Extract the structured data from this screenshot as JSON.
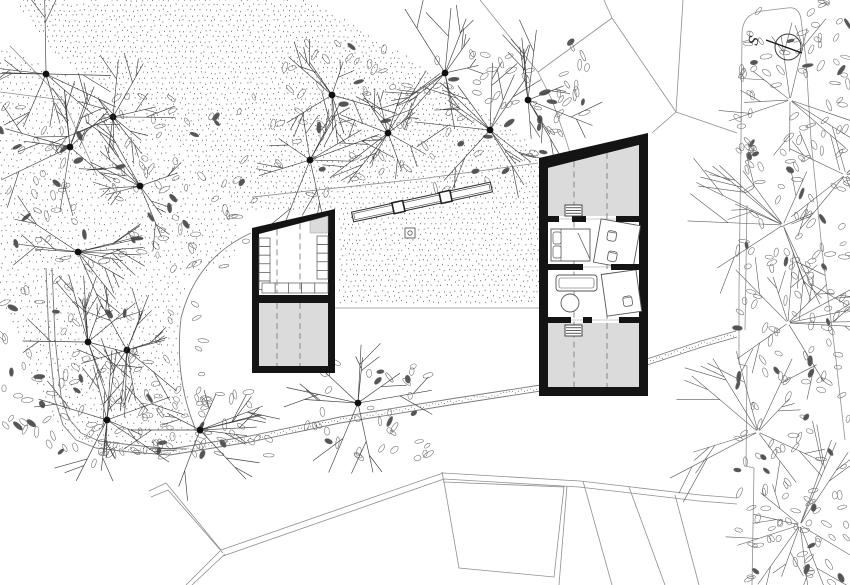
{
  "canvas": {
    "width": 850,
    "height": 585,
    "bg": "#ffffff"
  },
  "colors": {
    "wall": "#141414",
    "room_gray": "#dbdbdb",
    "thin_line": "#8f8f8f",
    "path_line": "#7a7a7a",
    "dot": "#4d4d4d",
    "leaf": "#6a6a6a",
    "leaf_fill": "#555555",
    "branch": "#3f3f3f",
    "hedge_branch": "#5a5a5a",
    "furniture": "#555555",
    "dash": "#808080",
    "trunk": "#111111"
  },
  "compass": {
    "label": "S",
    "cx": 788,
    "cy": 47,
    "r": 13,
    "needle": [
      766,
      40,
      802,
      53
    ],
    "label_pos": [
      758,
      42
    ],
    "label_rotate": -72
  },
  "stipple_regions": [
    {
      "polygon": [
        [
          15,
          0
        ],
        [
          310,
          0
        ],
        [
          420,
          65
        ],
        [
          538,
          150
        ],
        [
          538,
          306
        ],
        [
          338,
          306
        ],
        [
          338,
          212
        ],
        [
          240,
          212
        ],
        [
          150,
          118
        ],
        [
          55,
          55
        ]
      ],
      "spacing": 5.2,
      "jitter": 1.3
    },
    {
      "polygon": [
        [
          0,
          45
        ],
        [
          140,
          115
        ],
        [
          232,
          205
        ],
        [
          237,
          255
        ],
        [
          186,
          278
        ],
        [
          176,
          330
        ],
        [
          188,
          405
        ],
        [
          205,
          443
        ],
        [
          120,
          448
        ],
        [
          60,
          430
        ],
        [
          0,
          305
        ]
      ],
      "spacing": 6.4,
      "jitter": 1.6
    }
  ],
  "leaf_regions": [
    {
      "x": 0,
      "y": 90,
      "w": 70,
      "h": 380,
      "count": 60
    },
    {
      "x": 55,
      "y": 95,
      "w": 200,
      "h": 175,
      "count": 85
    },
    {
      "x": 55,
      "y": 300,
      "w": 150,
      "h": 165,
      "count": 65
    },
    {
      "x": 270,
      "y": 40,
      "w": 290,
      "h": 155,
      "count": 100
    },
    {
      "x": 538,
      "y": 42,
      "w": 52,
      "h": 100,
      "count": 22
    },
    {
      "x": 95,
      "y": 390,
      "w": 175,
      "h": 70,
      "count": 45
    },
    {
      "x": 305,
      "y": 355,
      "w": 125,
      "h": 105,
      "count": 40
    },
    {
      "x": 737,
      "y": 0,
      "w": 113,
      "h": 585,
      "count": 250
    }
  ],
  "trees": {
    "dotted": [
      [
        46,
        74
      ],
      [
        113,
        117
      ],
      [
        70,
        147
      ],
      [
        140,
        186
      ],
      [
        78,
        252
      ],
      [
        310,
        160
      ],
      [
        332,
        95
      ],
      [
        388,
        133
      ],
      [
        445,
        73
      ],
      [
        490,
        130
      ],
      [
        528,
        100
      ],
      [
        88,
        342
      ],
      [
        127,
        350
      ],
      [
        107,
        420
      ],
      [
        200,
        430
      ],
      [
        358,
        403
      ]
    ],
    "plain": [
      [
        790,
        100
      ],
      [
        783,
        225
      ],
      [
        788,
        323
      ],
      [
        758,
        432
      ],
      [
        800,
        525
      ],
      [
        845,
        175
      ]
    ]
  },
  "lines": {
    "thin_polylines": [
      [
        [
          480,
          0
        ],
        [
          538,
          72
        ],
        [
          552,
          100
        ],
        [
          566,
          140
        ],
        [
          574,
          166
        ]
      ],
      [
        [
          538,
          72
        ],
        [
          612,
          18
        ],
        [
          604,
          0
        ]
      ],
      [
        [
          612,
          18
        ],
        [
          676,
          112
        ],
        [
          737,
          133
        ]
      ],
      [
        [
          683,
          0
        ],
        [
          676,
          112
        ]
      ],
      [
        [
          652,
          133
        ],
        [
          676,
          112
        ]
      ],
      [
        [
          252,
          197
        ],
        [
          420,
          179
        ],
        [
          538,
          163
        ]
      ],
      [
        [
          10,
          46
        ],
        [
          63,
          100
        ],
        [
          97,
          176
        ]
      ],
      [
        [
          0,
          92
        ],
        [
          63,
          100
        ]
      ],
      [
        [
          335,
          308
        ],
        [
          539,
          308
        ]
      ],
      [
        [
          567,
          486
        ],
        [
          559,
          585
        ]
      ],
      [
        [
          583,
          481
        ],
        [
          612,
          585
        ]
      ],
      [
        [
          629,
          487
        ],
        [
          665,
          585
        ]
      ],
      [
        [
          675,
          495
        ],
        [
          699,
          585
        ]
      ],
      [
        [
          442,
          472
        ],
        [
          444,
          483
        ]
      ],
      [
        [
          742,
          34
        ],
        [
          741,
          140
        ],
        [
          739,
          290
        ],
        [
          739,
          364
        ],
        [
          747,
          366
        ],
        [
          746,
          466
        ],
        [
          754,
          468
        ],
        [
          752,
          585
        ]
      ],
      [
        [
          747,
          205
        ],
        [
          745,
          330
        ]
      ],
      [
        [
          742,
          42
        ],
        [
          749,
          40
        ],
        [
          750,
          31
        ]
      ],
      [
        [
          149,
          491
        ],
        [
          166,
          483
        ],
        [
          221,
          550
        ]
      ],
      [
        [
          151,
          497
        ],
        [
          168,
          490
        ],
        [
          223,
          553
        ]
      ],
      [
        [
          220,
          551
        ],
        [
          186,
          585
        ]
      ],
      [
        [
          225,
          554
        ],
        [
          192,
          585
        ]
      ],
      [
        [
          221,
          550
        ],
        [
          443,
          473
        ],
        [
          580,
          481
        ],
        [
          700,
          495
        ],
        [
          737,
          498
        ]
      ],
      [
        [
          223,
          556
        ],
        [
          444,
          479
        ],
        [
          579,
          487
        ],
        [
          699,
          501
        ],
        [
          737,
          504
        ]
      ]
    ],
    "pentagon": [
      [
        444,
        482
      ],
      [
        564,
        487
      ],
      [
        554,
        577
      ],
      [
        459,
        568
      ]
    ],
    "arc_path": "M 251 233 Q 196 258 181 318 Q 175 372 191 417 L 196 431",
    "hedge_cap_path": "M 742 34 Q 742 14 762 11 L 787 8 Q 799 6 801 19 L 806 60 L 811 140 L 822 250 L 836 360 L 845 440"
  },
  "gravel_path": {
    "outer": [
      [
        46,
        268
      ],
      [
        49,
        340
      ],
      [
        55,
        400
      ],
      [
        63,
        425
      ],
      [
        76,
        440
      ],
      [
        96,
        448
      ],
      [
        130,
        452
      ],
      [
        170,
        455
      ],
      [
        250,
        442
      ],
      [
        340,
        423
      ],
      [
        450,
        405
      ],
      [
        560,
        388
      ],
      [
        650,
        364
      ],
      [
        702,
        347
      ],
      [
        737,
        337
      ]
    ],
    "inner": [
      [
        52,
        268
      ],
      [
        55,
        338
      ],
      [
        61,
        396
      ],
      [
        69,
        419
      ],
      [
        81,
        433
      ],
      [
        99,
        441
      ],
      [
        132,
        445
      ],
      [
        170,
        449
      ],
      [
        250,
        436
      ],
      [
        340,
        417
      ],
      [
        450,
        399
      ],
      [
        560,
        382
      ],
      [
        650,
        358
      ],
      [
        701,
        341
      ],
      [
        736,
        331
      ]
    ],
    "center": [
      [
        49,
        268
      ],
      [
        52,
        339
      ],
      [
        58,
        398
      ],
      [
        66,
        422
      ],
      [
        79,
        437
      ],
      [
        98,
        445
      ],
      [
        131,
        449
      ],
      [
        170,
        452
      ],
      [
        250,
        439
      ],
      [
        340,
        420
      ],
      [
        450,
        402
      ],
      [
        560,
        385
      ],
      [
        650,
        361
      ],
      [
        701,
        344
      ],
      [
        736,
        334
      ]
    ],
    "dots_from_index": 4
  },
  "bench": {
    "cx": 422,
    "cy": 202,
    "len": 142,
    "wid": 10,
    "rot": -12.2,
    "squares": [
      0.33,
      0.67
    ],
    "sq": 11
  },
  "marker": {
    "rect": [
      405,
      228,
      10,
      10
    ],
    "r": 2.2
  },
  "left_cabin": {
    "outer": [
      [
        252,
        228
      ],
      [
        335,
        209
      ],
      [
        335,
        373
      ],
      [
        252,
        373
      ]
    ],
    "inner": [
      [
        259,
        234
      ],
      [
        328,
        216
      ],
      [
        328,
        366
      ],
      [
        259,
        366
      ]
    ],
    "divider": [
      252,
      295,
      335,
      303
    ],
    "bottom_room": [
      [
        259,
        303
      ],
      [
        328,
        303
      ],
      [
        328,
        366
      ],
      [
        259,
        366
      ]
    ],
    "gray_quad": [
      [
        310,
        221
      ],
      [
        328,
        216
      ],
      [
        328,
        233
      ],
      [
        310,
        233
      ]
    ],
    "shelves": {
      "left": {
        "x": 259,
        "w": 11,
        "y0": 238,
        "rows": 6,
        "rh": 8.6
      },
      "right": {
        "x": 317,
        "w": 11,
        "y0": 236,
        "rows": 5,
        "rh": 8.6
      },
      "bottom": {
        "x0": 262,
        "cw": 13.2,
        "cols": 5,
        "y": 283,
        "h": 10
      }
    },
    "dashes": [
      [
        277,
        229.5,
        293
      ],
      [
        300,
        223.5,
        293
      ],
      [
        277,
        303,
        366
      ],
      [
        300,
        303,
        366
      ]
    ]
  },
  "right_cabin": {
    "outer": [
      [
        539,
        158
      ],
      [
        648,
        133
      ],
      [
        648,
        396
      ],
      [
        539,
        396
      ]
    ],
    "inner": [
      [
        548,
        168
      ],
      [
        639,
        145
      ],
      [
        639,
        387
      ],
      [
        548,
        387
      ]
    ],
    "gray_rooms": [
      [
        [
          548,
          168
        ],
        [
          639,
          145
        ],
        [
          639,
          216
        ],
        [
          548,
          216
        ]
      ],
      [
        [
          548,
          323
        ],
        [
          639,
          323
        ],
        [
          639,
          387
        ],
        [
          548,
          387
        ]
      ]
    ],
    "thresholds": [
      219,
      267,
      320
    ],
    "bands": [
      {
        "y": 216,
        "h": 6,
        "segs": [
          [
            548,
            559
          ],
          [
            572,
            586
          ],
          [
            616,
            639
          ]
        ]
      },
      {
        "y": 264,
        "h": 6,
        "segs": [
          [
            548,
            583
          ],
          [
            611,
            639
          ]
        ]
      },
      {
        "y": 317,
        "h": 6,
        "segs": [
          [
            548,
            571
          ],
          [
            583,
            592
          ],
          [
            619,
            639
          ]
        ]
      }
    ],
    "dashes": [
      [
        574,
        161.5,
        387
      ],
      [
        607,
        153,
        387
      ]
    ],
    "stairs": [
      [
        565,
        205,
        17,
        11
      ],
      [
        565,
        325,
        17,
        11
      ]
    ],
    "furniture": {
      "bed": {
        "rect": [
          551,
          229,
          39,
          32
        ],
        "head_x": 561,
        "pillows": [
          [
            553,
            232,
            8,
            12
          ],
          [
            553,
            246,
            8,
            12
          ]
        ],
        "fold": [
          578,
          233,
          590,
          259
        ]
      },
      "desk1": {
        "rect": [
          597,
          222,
          40,
          44
        ],
        "rot": 10,
        "cx": 617,
        "cy": 244,
        "chairs": [
          [
            606,
            232
          ],
          [
            610,
            252
          ]
        ]
      },
      "sofa": {
        "outer": [
          556,
          275,
          41,
          16
        ],
        "inner": [
          559,
          278,
          35,
          10
        ]
      },
      "table": {
        "cx": 570,
        "cy": 303,
        "r": 9
      },
      "desk2": {
        "rect": [
          604,
          272,
          35,
          42
        ],
        "rot": -8,
        "cx": 621,
        "cy": 293,
        "chairs": [
          [
            622,
            297
          ]
        ]
      }
    }
  }
}
